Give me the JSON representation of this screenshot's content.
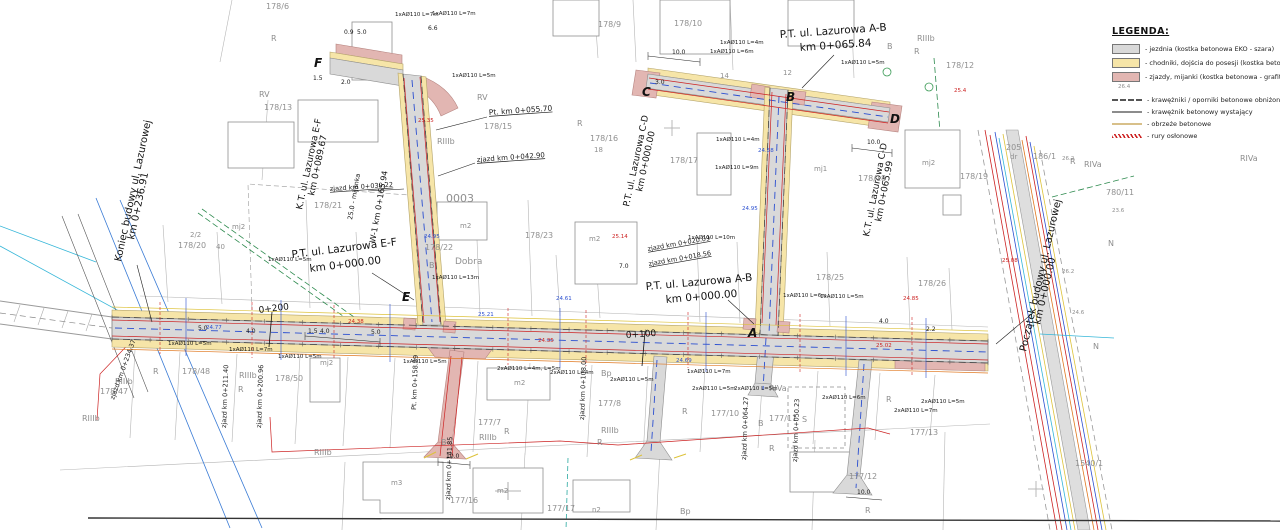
{
  "legend": {
    "title": "LEGENDA:",
    "items": [
      {
        "kind": "area",
        "color": "#d9d9d9",
        "label": "- jezdnia (kostka betonowa EKO - szara)"
      },
      {
        "kind": "area",
        "color": "#f6e5a8",
        "label": "- chodniki, dojścia do posesji (kostka betonowa - szara)"
      },
      {
        "kind": "area",
        "color": "#e2b6b2",
        "label": "- zjazdy, mijanki (kostka betonowa - grafitowa)"
      },
      {
        "kind": "dashed",
        "color": "#555555",
        "label": "- krawężniki / oporniki betonowe obniżone",
        "gap": true
      },
      {
        "kind": "solid",
        "color": "#8c8c8c",
        "label": "- krawężnik betonowy wystający"
      },
      {
        "kind": "solid",
        "color": "#d8c08a",
        "label": "- obrzeże betonowe"
      },
      {
        "kind": "hatch",
        "color": "#cc2222",
        "label": "- rury osłonowe"
      }
    ]
  },
  "colors": {
    "jezdnia": "#d9d9d9",
    "chodnik": "#f6e5a8",
    "zjazd": "#e2b6b2",
    "water_blue": "#2b4fd0",
    "pipe_red": "#cc2222",
    "cyan": "#35b6d8",
    "yellow": "#ddc23a",
    "orange": "#e07820",
    "green": "#2d8a4e",
    "gray_text": "#909090"
  },
  "labels": {
    "streets": [
      {
        "text": "P.T. ul. Lazurowa A-B",
        "x": 780,
        "y": 38,
        "r": -4,
        "s": 10.5
      },
      {
        "text": "km 0+065.84",
        "x": 800,
        "y": 51,
        "r": -4,
        "s": 10.5
      },
      {
        "text": "P.T. ul. Lazurowa E-F",
        "x": 292,
        "y": 258,
        "r": -7,
        "s": 10.5
      },
      {
        "text": "km 0+000.00",
        "x": 310,
        "y": 272,
        "r": -7,
        "s": 10.5
      },
      {
        "text": "P.T. ul. Lazurowa A-B",
        "x": 646,
        "y": 290,
        "r": -5,
        "s": 10.5
      },
      {
        "text": "km 0+000.00",
        "x": 666,
        "y": 303,
        "r": -5,
        "s": 10.5
      },
      {
        "text": "Koniec budowy ul. Lazurowej",
        "x": 121,
        "y": 262,
        "r": -78,
        "s": 10
      },
      {
        "text": "km 0+236.91",
        "x": 134,
        "y": 240,
        "r": -78,
        "s": 10
      },
      {
        "text": "Początek budowy ul. Lazurowej",
        "x": 1026,
        "y": 352,
        "r": -77,
        "s": 10
      },
      {
        "text": "km 0+000.00",
        "x": 1040,
        "y": 325,
        "r": -77,
        "s": 10
      },
      {
        "text": "K.T. ul. Lazurowa E-F",
        "x": 302,
        "y": 210,
        "r": -78,
        "s": 9
      },
      {
        "text": "km 0+089.67",
        "x": 314,
        "y": 196,
        "r": -78,
        "s": 9
      },
      {
        "text": "P.T. ul. Lazurowa C-D",
        "x": 629,
        "y": 207,
        "r": -78,
        "s": 9
      },
      {
        "text": "km 0+000.00",
        "x": 642,
        "y": 192,
        "r": -78,
        "s": 9
      },
      {
        "text": "K.T. ul. Lazurowa C-D",
        "x": 869,
        "y": 237,
        "r": -79,
        "s": 9
      },
      {
        "text": "km 0+065.99",
        "x": 881,
        "y": 222,
        "r": -79,
        "s": 9
      },
      {
        "text": "W-1 km 0+165.94",
        "x": 375,
        "y": 243,
        "r": -80,
        "s": 8
      },
      {
        "text": "25.0 - mijanka",
        "x": 352,
        "y": 220,
        "r": -80,
        "s": 6.5
      }
    ],
    "chainage": [
      {
        "text": "0+200",
        "x": 259,
        "y": 313,
        "r": -7,
        "s": 9
      },
      {
        "text": "0+100",
        "x": 626,
        "y": 338,
        "r": -4,
        "s": 9
      }
    ],
    "nodes": [
      {
        "text": "A",
        "x": 748,
        "y": 337
      },
      {
        "text": "B",
        "x": 786,
        "y": 101
      },
      {
        "text": "C",
        "x": 642,
        "y": 96
      },
      {
        "text": "D",
        "x": 890,
        "y": 123
      },
      {
        "text": "E",
        "x": 402,
        "y": 301
      },
      {
        "text": "F",
        "x": 314,
        "y": 67
      }
    ],
    "parcels": [
      {
        "text": "178/6",
        "x": 266,
        "y": 9
      },
      {
        "text": "178/9",
        "x": 598,
        "y": 27
      },
      {
        "text": "178/10",
        "x": 674,
        "y": 26
      },
      {
        "text": "178/12",
        "x": 946,
        "y": 68
      },
      {
        "text": "178/13",
        "x": 264,
        "y": 110
      },
      {
        "text": "178/15",
        "x": 484,
        "y": 129
      },
      {
        "text": "178/16",
        "x": 590,
        "y": 141
      },
      {
        "text": "18",
        "x": 594,
        "y": 152,
        "s": 7
      },
      {
        "text": "178/17",
        "x": 670,
        "y": 163
      },
      {
        "text": "178/18",
        "x": 858,
        "y": 181
      },
      {
        "text": "178/19",
        "x": 960,
        "y": 179
      },
      {
        "text": "178/20",
        "x": 178,
        "y": 248
      },
      {
        "text": "178/21",
        "x": 314,
        "y": 208
      },
      {
        "text": "178/22",
        "x": 425,
        "y": 250
      },
      {
        "text": "178/23",
        "x": 525,
        "y": 238
      },
      {
        "text": "178/25",
        "x": 816,
        "y": 280
      },
      {
        "text": "178/26",
        "x": 918,
        "y": 286
      },
      {
        "text": "178/47",
        "x": 100,
        "y": 394
      },
      {
        "text": "178/48",
        "x": 182,
        "y": 374
      },
      {
        "text": "178/50",
        "x": 275,
        "y": 381
      },
      {
        "text": "177/7",
        "x": 478,
        "y": 425
      },
      {
        "text": "177/8",
        "x": 598,
        "y": 406
      },
      {
        "text": "177/10",
        "x": 711,
        "y": 416
      },
      {
        "text": "177/11",
        "x": 769,
        "y": 421
      },
      {
        "text": "177/12",
        "x": 849,
        "y": 479
      },
      {
        "text": "177/13",
        "x": 910,
        "y": 435
      },
      {
        "text": "177/16",
        "x": 450,
        "y": 503
      },
      {
        "text": "177/17",
        "x": 547,
        "y": 511
      },
      {
        "text": "780/11",
        "x": 1106,
        "y": 195
      },
      {
        "text": "205",
        "x": 1006,
        "y": 150
      },
      {
        "text": "dr",
        "x": 1010,
        "y": 159,
        "s": 7
      },
      {
        "text": "186/1",
        "x": 1033,
        "y": 159
      },
      {
        "text": "1540/1",
        "x": 1075,
        "y": 466
      },
      {
        "text": "0003",
        "x": 446,
        "y": 202,
        "s": 11
      },
      {
        "text": "Dobra",
        "x": 455,
        "y": 264,
        "s": 9
      },
      {
        "text": "2/2",
        "x": 190,
        "y": 237,
        "s": 7
      },
      {
        "text": "40",
        "x": 216,
        "y": 249,
        "s": 7
      },
      {
        "text": "12",
        "x": 783,
        "y": 75,
        "s": 7
      },
      {
        "text": "14",
        "x": 720,
        "y": 78,
        "s": 7
      }
    ],
    "soil": [
      {
        "text": "R",
        "x": 271,
        "y": 41
      },
      {
        "text": "RV",
        "x": 259,
        "y": 97
      },
      {
        "text": "RIIIb",
        "x": 917,
        "y": 41
      },
      {
        "text": "R",
        "x": 914,
        "y": 54
      },
      {
        "text": "RV",
        "x": 477,
        "y": 100
      },
      {
        "text": "RIIIb",
        "x": 437,
        "y": 144
      },
      {
        "text": "R",
        "x": 577,
        "y": 126
      },
      {
        "text": "RIIIb",
        "x": 479,
        "y": 440
      },
      {
        "text": "RIIIb",
        "x": 601,
        "y": 433
      },
      {
        "text": "R",
        "x": 597,
        "y": 445
      },
      {
        "text": "Bp",
        "x": 601,
        "y": 376
      },
      {
        "text": "R",
        "x": 682,
        "y": 414
      },
      {
        "text": "RIVa",
        "x": 769,
        "y": 391
      },
      {
        "text": "R",
        "x": 769,
        "y": 451
      },
      {
        "text": "S",
        "x": 802,
        "y": 422
      },
      {
        "text": "R",
        "x": 886,
        "y": 402
      },
      {
        "text": "R",
        "x": 865,
        "y": 513
      },
      {
        "text": "RIIIb",
        "x": 314,
        "y": 455
      },
      {
        "text": "RIIIb",
        "x": 115,
        "y": 384
      },
      {
        "text": "R",
        "x": 153,
        "y": 374
      },
      {
        "text": "RIIIb",
        "x": 239,
        "y": 378
      },
      {
        "text": "R",
        "x": 238,
        "y": 392
      },
      {
        "text": "N",
        "x": 1108,
        "y": 246
      },
      {
        "text": "N",
        "x": 1093,
        "y": 349
      },
      {
        "text": "R",
        "x": 1070,
        "y": 164
      },
      {
        "text": "RIVa",
        "x": 1084,
        "y": 167
      },
      {
        "text": "RIVa",
        "x": 1240,
        "y": 161
      },
      {
        "text": "B",
        "x": 429,
        "y": 268
      },
      {
        "text": "B",
        "x": 887,
        "y": 49
      },
      {
        "text": "B",
        "x": 758,
        "y": 426
      },
      {
        "text": "B",
        "x": 441,
        "y": 445
      },
      {
        "text": "Bp",
        "x": 680,
        "y": 514
      },
      {
        "text": "R",
        "x": 504,
        "y": 434
      },
      {
        "text": "RIIIb",
        "x": 82,
        "y": 421
      }
    ],
    "buildings_text": [
      {
        "text": "mj2",
        "x": 232,
        "y": 229
      },
      {
        "text": "mj2",
        "x": 922,
        "y": 165
      },
      {
        "text": "mj1",
        "x": 814,
        "y": 171
      },
      {
        "text": "mj2",
        "x": 320,
        "y": 365
      },
      {
        "text": "m2",
        "x": 514,
        "y": 385
      },
      {
        "text": "m2",
        "x": 497,
        "y": 493
      },
      {
        "text": "m3",
        "x": 391,
        "y": 485
      },
      {
        "text": "n2",
        "x": 592,
        "y": 512
      },
      {
        "text": "m2",
        "x": 589,
        "y": 241
      },
      {
        "text": "m2",
        "x": 460,
        "y": 228
      }
    ],
    "pipes": [
      {
        "text": "1xAØ110 L=5m",
        "x": 168,
        "y": 345
      },
      {
        "text": "1xAØ110 L=7m",
        "x": 229,
        "y": 351
      },
      {
        "text": "1xAØ110 L=5m",
        "x": 278,
        "y": 358
      },
      {
        "text": "1xAØ110 L=5m",
        "x": 403,
        "y": 363
      },
      {
        "text": "2xAØ110 L=4m, L=5m",
        "x": 497,
        "y": 370
      },
      {
        "text": "2xAØ110 L=4m",
        "x": 550,
        "y": 374
      },
      {
        "text": "2xAØ110 L=5m",
        "x": 610,
        "y": 381
      },
      {
        "text": "1xAØ110 L=7m",
        "x": 687,
        "y": 373
      },
      {
        "text": "2xAØ110 L=5m",
        "x": 692,
        "y": 390
      },
      {
        "text": "2xAØ110 L=5m",
        "x": 734,
        "y": 390
      },
      {
        "text": "2xAØ110 L=6m",
        "x": 822,
        "y": 399
      },
      {
        "text": "2xAØ110 L=5m",
        "x": 921,
        "y": 403
      },
      {
        "text": "2xAØ110 L=7m",
        "x": 894,
        "y": 412
      },
      {
        "text": "1xAØ110 L=6m",
        "x": 783,
        "y": 297
      },
      {
        "text": "1xAØ110 L=5m",
        "x": 820,
        "y": 298
      },
      {
        "text": "1xAØ110 L=13m",
        "x": 432,
        "y": 279
      },
      {
        "text": "1xAØ110 L=5m",
        "x": 268,
        "y": 261
      },
      {
        "text": "1xAØ110 L=10m",
        "x": 688,
        "y": 239
      },
      {
        "text": "1xAØ110 L=5m",
        "x": 841,
        "y": 64
      },
      {
        "text": "1xAØ110 L=7m",
        "x": 395,
        "y": 16
      },
      {
        "text": "1xAØ110 L=7m",
        "x": 432,
        "y": 15
      },
      {
        "text": "1xAØ110 L=5m",
        "x": 452,
        "y": 77
      },
      {
        "text": "1xAØ110 L=4m",
        "x": 720,
        "y": 44
      },
      {
        "text": "1xAØ110 L=6m",
        "x": 710,
        "y": 53
      },
      {
        "text": "1xAØ110 L=4m",
        "x": 716,
        "y": 141
      },
      {
        "text": "1xAØ110 L=9m",
        "x": 715,
        "y": 169
      }
    ],
    "zjazdy": [
      {
        "text": "Pt. km 0+055.70",
        "x": 489,
        "y": 115,
        "r": -4,
        "s": 7.5,
        "u": 1
      },
      {
        "text": "zjazd km 0+042.90",
        "x": 477,
        "y": 162,
        "r": -4,
        "s": 7,
        "u": 1
      },
      {
        "text": "zjazd km 0+039.22",
        "x": 330,
        "y": 191,
        "r": -4,
        "s": 6.5,
        "u": 1
      },
      {
        "text": "zjazd km 0+020.09",
        "x": 648,
        "y": 251,
        "r": -10,
        "s": 6.5,
        "u": 1
      },
      {
        "text": "zjazd km 0+018.56",
        "x": 649,
        "y": 266,
        "r": -10,
        "s": 6.5,
        "u": 1
      },
      {
        "text": "zjazd km 0+211.40",
        "x": 226,
        "y": 428,
        "r": -88,
        "s": 6.5
      },
      {
        "text": "zjazd km 0+200.96",
        "x": 261,
        "y": 428,
        "r": -88,
        "s": 6.5
      },
      {
        "text": "zjazd km 0+234.37",
        "x": 114,
        "y": 400,
        "r": -70,
        "s": 6.5
      },
      {
        "text": "zjazd km 0+141.85",
        "x": 450,
        "y": 500,
        "r": -88,
        "s": 6.5
      },
      {
        "text": "Pt. km 0+158.29",
        "x": 416,
        "y": 410,
        "r": -88,
        "s": 6.5
      },
      {
        "text": "zjazd km 0+108.00",
        "x": 584,
        "y": 420,
        "r": -88,
        "s": 6.5
      },
      {
        "text": "zjazd km 0+064.27",
        "x": 746,
        "y": 460,
        "r": -88,
        "s": 6.5
      },
      {
        "text": "zjazd km 0+050.23",
        "x": 797,
        "y": 462,
        "r": -88,
        "s": 6.5
      }
    ],
    "dims": [
      {
        "text": "0.9",
        "x": 344,
        "y": 34
      },
      {
        "text": "5.0",
        "x": 357,
        "y": 34
      },
      {
        "text": "6.6",
        "x": 428,
        "y": 30
      },
      {
        "text": "1.5",
        "x": 313,
        "y": 80
      },
      {
        "text": "2.0",
        "x": 341,
        "y": 84
      },
      {
        "text": "1.5",
        "x": 308,
        "y": 333
      },
      {
        "text": "4.0",
        "x": 320,
        "y": 333
      },
      {
        "text": "5.0",
        "x": 371,
        "y": 334
      },
      {
        "text": "10.0",
        "x": 672,
        "y": 54
      },
      {
        "text": "3.0",
        "x": 655,
        "y": 84
      },
      {
        "text": "10.0",
        "x": 867,
        "y": 144
      },
      {
        "text": "10.0",
        "x": 446,
        "y": 458
      },
      {
        "text": "10.0",
        "x": 857,
        "y": 494
      },
      {
        "text": "7.0",
        "x": 619,
        "y": 268
      },
      {
        "text": "4.0",
        "x": 879,
        "y": 323
      },
      {
        "text": "2.2",
        "x": 926,
        "y": 331
      },
      {
        "text": "5.0",
        "x": 198,
        "y": 330
      },
      {
        "text": "4.0",
        "x": 246,
        "y": 333
      }
    ],
    "elevations": [
      {
        "text": "24.95",
        "x": 742,
        "y": 210,
        "c": "b"
      },
      {
        "text": "25.14",
        "x": 612,
        "y": 238,
        "c": "r"
      },
      {
        "text": "24.61",
        "x": 556,
        "y": 300,
        "c": "b"
      },
      {
        "text": "24.85",
        "x": 903,
        "y": 300,
        "c": "r"
      },
      {
        "text": "25.21",
        "x": 478,
        "y": 316,
        "c": "b"
      },
      {
        "text": "24.38",
        "x": 348,
        "y": 323,
        "c": "r"
      },
      {
        "text": "24.77",
        "x": 206,
        "y": 329,
        "c": "b"
      },
      {
        "text": "25.02",
        "x": 876,
        "y": 347,
        "c": "r"
      },
      {
        "text": "24.69",
        "x": 676,
        "y": 362,
        "c": "b"
      },
      {
        "text": "25.08",
        "x": 1002,
        "y": 262,
        "c": "r"
      },
      {
        "text": "24.58",
        "x": 758,
        "y": 152,
        "c": "b"
      },
      {
        "text": "25.35",
        "x": 418,
        "y": 122,
        "c": "r"
      },
      {
        "text": "26.2",
        "x": 1062,
        "y": 160,
        "c": "g"
      },
      {
        "text": "23.6",
        "x": 1112,
        "y": 212,
        "c": "g"
      },
      {
        "text": "26.2",
        "x": 1062,
        "y": 273,
        "c": "g"
      },
      {
        "text": "24.6",
        "x": 1072,
        "y": 314,
        "c": "g"
      },
      {
        "text": "24.95",
        "x": 424,
        "y": 238,
        "c": "b"
      },
      {
        "text": "24.35",
        "x": 538,
        "y": 342,
        "c": "r"
      },
      {
        "text": "26.4",
        "x": 1118,
        "y": 88,
        "c": "g"
      },
      {
        "text": "25.4",
        "x": 954,
        "y": 92,
        "c": "r"
      }
    ]
  }
}
